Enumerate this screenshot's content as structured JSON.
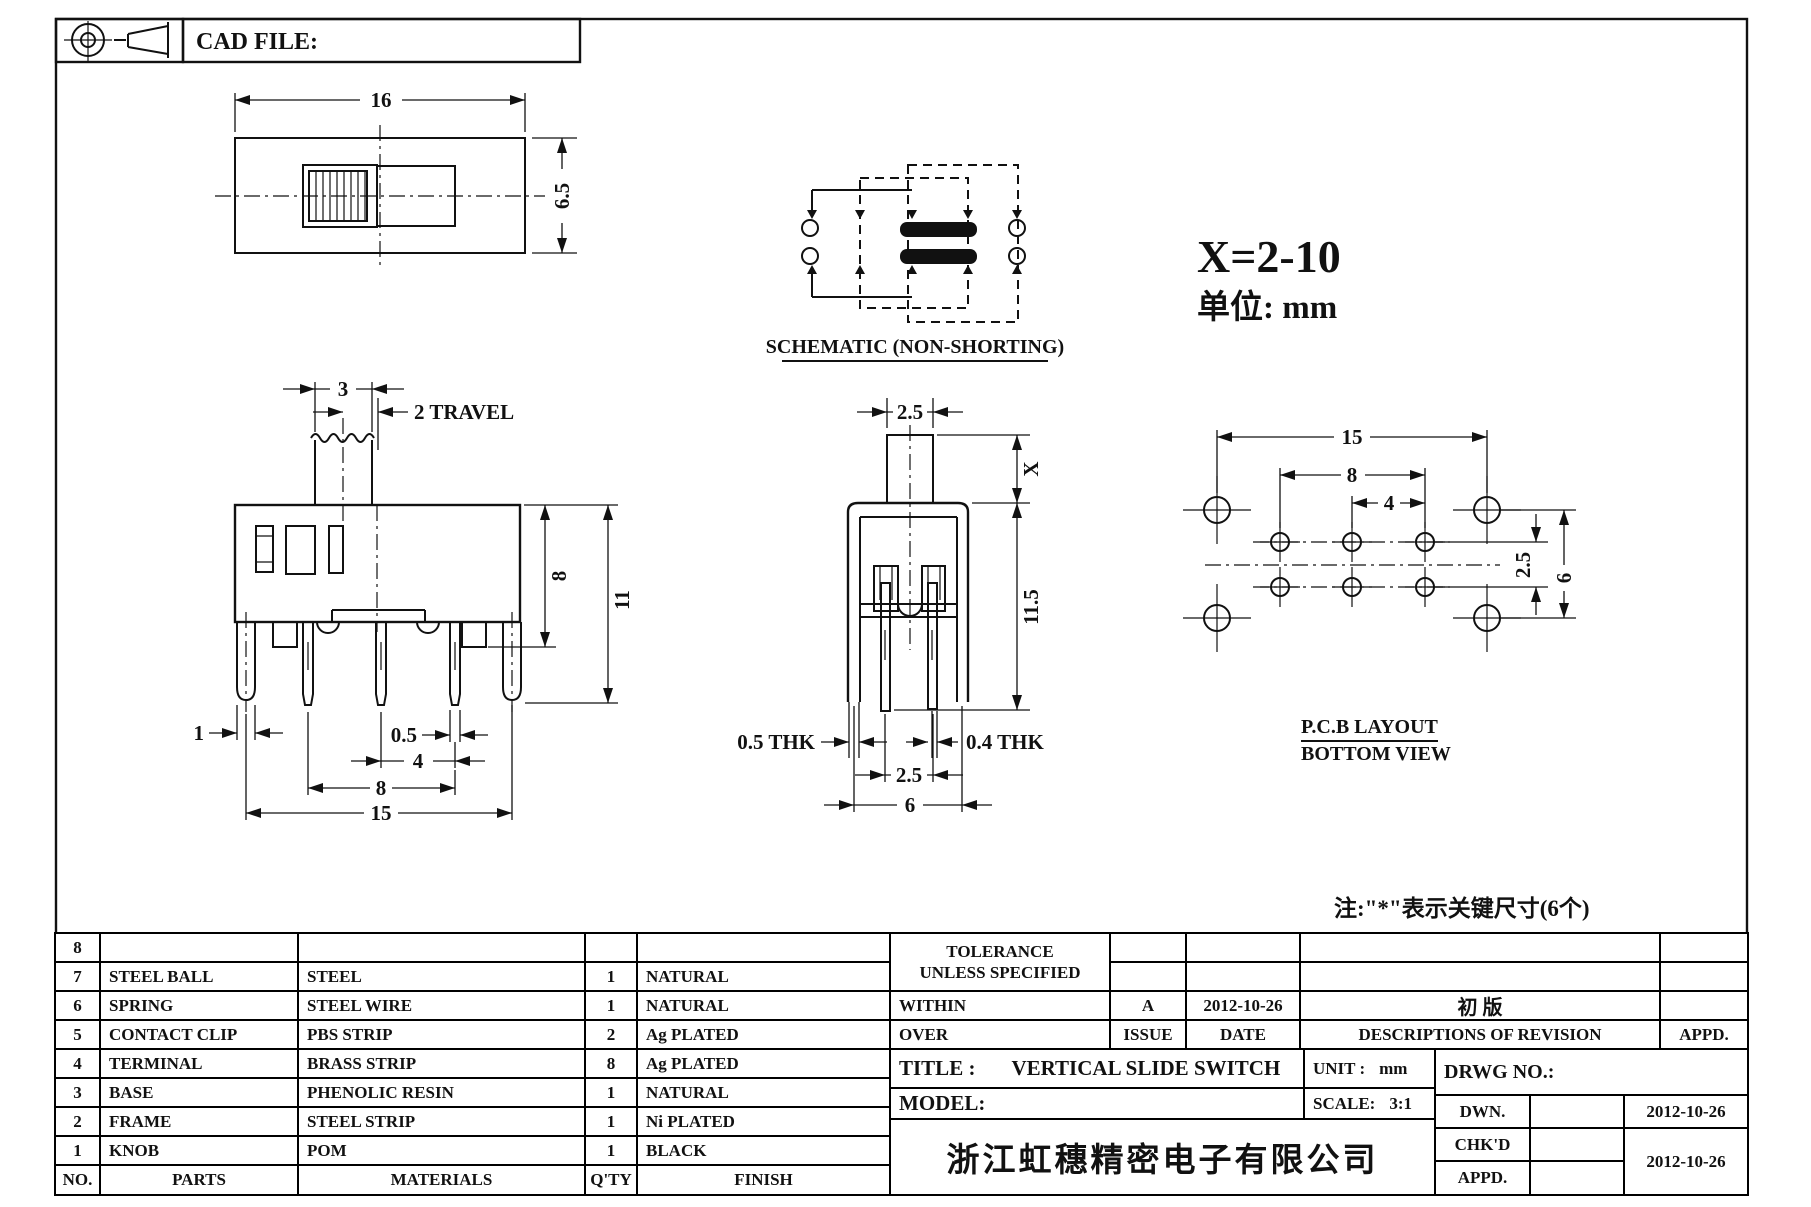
{
  "header": {
    "cad_file_label": "CAD FILE:"
  },
  "annotations": {
    "x_range": "X=2-10",
    "unit_note": "单位:  mm",
    "key_note": "注:\"*\"表示关键尺寸(6个)",
    "schematic_label": "SCHEMATIC (NON-SHORTING)",
    "pcb_label_1": "P.C.B LAYOUT",
    "pcb_label_2": "BOTTOM VIEW"
  },
  "dims": {
    "top_view": {
      "width": "16",
      "height": "6.5"
    },
    "front_view": {
      "knob_w": "3",
      "travel": "2 TRAVEL",
      "body_h": "8",
      "total_h": "11",
      "peg_w": "1",
      "pin_w": "0.5",
      "pin_pitch": "4",
      "pin_span": "8",
      "peg_span": "15"
    },
    "side_view": {
      "stem_w": "2.5",
      "stem_h": "X",
      "body_h": "11.5",
      "thk_left": "0.5 THK",
      "thk_right": "0.4 THK",
      "pin_gap": "2.5",
      "leg_span": "6"
    },
    "pcb": {
      "outer_span": "15",
      "pin_span": "8",
      "pin_pitch": "4",
      "row_gap": "2.5",
      "outer_gap": "6"
    }
  },
  "parts_table": {
    "headers": {
      "no": "NO.",
      "parts": "PARTS",
      "materials": "MATERIALS",
      "qty": "Q'TY",
      "finish": "FINISH"
    },
    "rows": [
      {
        "no": "8",
        "part": "",
        "material": "",
        "qty": "",
        "finish": ""
      },
      {
        "no": "7",
        "part": "STEEL BALL",
        "material": "STEEL",
        "qty": "1",
        "finish": "NATURAL"
      },
      {
        "no": "6",
        "part": "SPRING",
        "material": "STEEL WIRE",
        "qty": "1",
        "finish": "NATURAL"
      },
      {
        "no": "5",
        "part": "CONTACT CLIP",
        "material": "PBS STRIP",
        "qty": "2",
        "finish": "Ag PLATED"
      },
      {
        "no": "4",
        "part": "TERMINAL",
        "material": "BRASS STRIP",
        "qty": "8",
        "finish": "Ag PLATED"
      },
      {
        "no": "3",
        "part": "BASE",
        "material": "PHENOLIC RESIN",
        "qty": "1",
        "finish": "NATURAL"
      },
      {
        "no": "2",
        "part": "FRAME",
        "material": "STEEL STRIP",
        "qty": "1",
        "finish": "Ni PLATED"
      },
      {
        "no": "1",
        "part": "KNOB",
        "material": "POM",
        "qty": "1",
        "finish": "BLACK"
      }
    ]
  },
  "title_block": {
    "tolerance_line1": "TOLERANCE",
    "tolerance_line2": "UNLESS  SPECIFIED",
    "within": "WITHIN",
    "over": "OVER",
    "issue_value": "A",
    "issue_label": "ISSUE",
    "date_value": "2012-10-26",
    "date_label": "DATE",
    "revision_value": "初  版",
    "revision_label": "DESCRIPTIONS OF REVISION",
    "appd_label": "APPD.",
    "title_label": "TITLE :",
    "title_value": "VERTICAL SLIDE SWITCH",
    "model_label": "MODEL:",
    "unit_label": "UNIT :",
    "unit_value": "mm",
    "scale_label": "SCALE:",
    "scale_value": "3:1",
    "drwg_label": "DRWG NO.:",
    "dwn_label": "DWN.",
    "chkd_label": "CHK'D",
    "appd2_label": "APPD.",
    "dwn_date": "2012-10-26",
    "chkd_date": "2012-10-26",
    "company": "浙江虹穗精密电子有限公司"
  }
}
